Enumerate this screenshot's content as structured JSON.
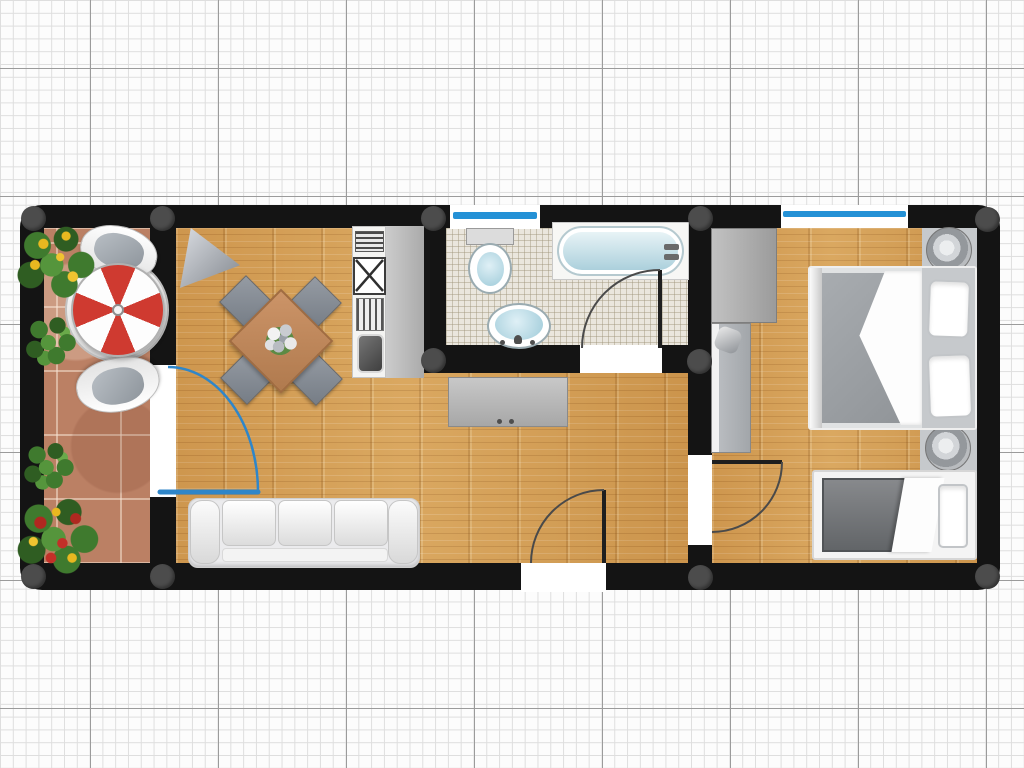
{
  "app": {
    "type": "floor-plan-viewer",
    "mode": "2d-top-view"
  },
  "grid": {
    "minor_cell_px": 12.8,
    "major_cell_px": 128
  },
  "colors": {
    "wall": "#141414",
    "grid_minor": "#dedede",
    "grid_major": "#9b9b9b",
    "window_blue": "#2491d6",
    "door_blue": "#2f86c9",
    "umbrella_red": "#cf3a30",
    "handle": "#4c4c4c",
    "counter": "#bdbdbd",
    "sofa": "#ebebed",
    "mattress": "#9aa0a4",
    "dark_mattress": "#6f7275"
  },
  "rooms": [
    {
      "name": "balcony",
      "floor": "terracotta-tile"
    },
    {
      "name": "living-room",
      "floor": "wood-parquet"
    },
    {
      "name": "kitchen",
      "floor": "wood-parquet"
    },
    {
      "name": "bathroom",
      "floor": "ceramic-tile"
    },
    {
      "name": "hallway",
      "floor": "wood-parquet"
    },
    {
      "name": "bedroom",
      "floor": "wood-parquet"
    }
  ],
  "windows": [
    {
      "name": "bathroom-window"
    },
    {
      "name": "bedroom-window"
    }
  ],
  "doors": [
    {
      "name": "balcony-door",
      "style": "blue-swing"
    },
    {
      "name": "bathroom-door",
      "style": "swing"
    },
    {
      "name": "bedroom-door",
      "style": "swing"
    },
    {
      "name": "entrance-door",
      "style": "swing"
    }
  ],
  "wall_handles": {
    "count": 11
  },
  "labels": {
    "balcony_table": "Balcony bistro table",
    "parasol": "Parasol",
    "balcony_chair": "Balcony chair",
    "plant": "Plant",
    "corner_lamp": "Corner lamp",
    "dining_table": "Dining table",
    "dining_chair": "Dining chair",
    "centerpiece": "Flower centerpiece",
    "kitchen_vent": "Extractor vent",
    "stove": "Cooktop",
    "dish_rack": "Dish rack",
    "kitchen_sink": "Kitchen sink",
    "kitchen_counter": "Kitchen counter",
    "sideboard": "Sideboard",
    "sofa": "Three-seat sofa",
    "toilet": "Toilet",
    "bathtub": "Bathtub",
    "washbasin": "Washbasin",
    "wardrobe": "Wardrobe",
    "tall_cabinet": "Tall cabinet",
    "double_bed": "Double bed",
    "single_bed": "Single bed",
    "pillow": "Pillow",
    "bedside_lamp": "Bedside lamp",
    "entrance": "Entrance door",
    "window": "Window",
    "wall_handle": "Wall joint handle"
  }
}
